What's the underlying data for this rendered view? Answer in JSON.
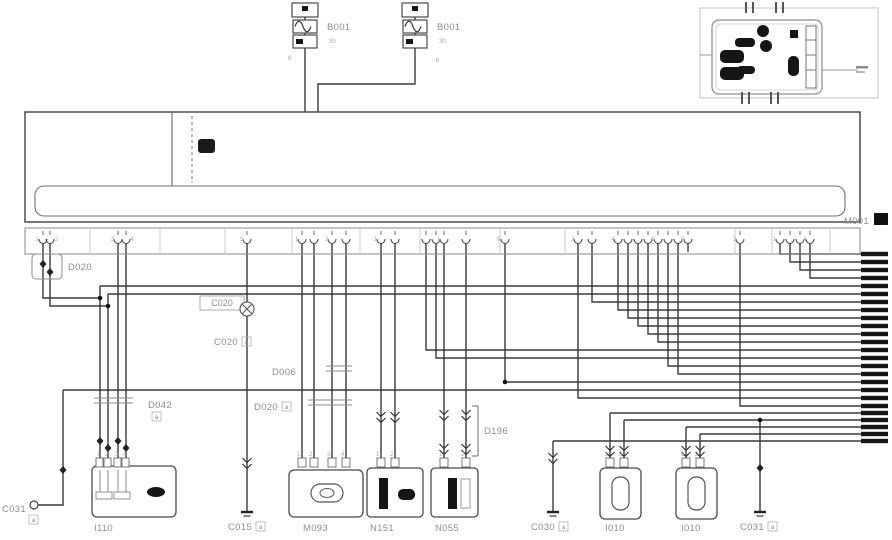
{
  "labels": {
    "fuse_a": "B001",
    "fuse_b": "B001",
    "main_unit": "M001",
    "d020": "D020",
    "c020_box": "C020",
    "c020a": {
      "text": "C020",
      "suffix": "a"
    },
    "d006": "D006",
    "d042": {
      "text": "D042",
      "suffix": "a"
    },
    "d020a": {
      "text": "D020",
      "suffix": "a"
    },
    "d196": "D196",
    "c031_left": {
      "text": "C031",
      "suffix": "a"
    },
    "c015": {
      "text": "C015",
      "suffix": "a"
    },
    "c030": {
      "text": "C030",
      "suffix": "a"
    },
    "c031_right": {
      "text": "C031",
      "suffix": "a"
    },
    "comp_left": "I110",
    "m093": "M093",
    "n151": "N151",
    "n055": "N055",
    "i010_a": "I010",
    "i010_b": "I010"
  },
  "colors": {
    "wire": "#3a3a3a",
    "tick": "#161616",
    "box": "#4a4a4a",
    "light_box": "#9a9a9a",
    "label": "#8f8f8f",
    "pin_number": "#a6a6a6",
    "fill_dark": "#151515"
  },
  "pin_labels": [
    {
      "x": 36,
      "y": 241,
      "t": "1"
    },
    {
      "x": 55,
      "y": 241,
      "t": "2"
    },
    {
      "x": 111,
      "y": 241,
      "t": "3"
    },
    {
      "x": 130,
      "y": 241,
      "t": "4"
    },
    {
      "x": 240,
      "y": 241,
      "t": "5"
    },
    {
      "x": 295,
      "y": 241,
      "t": "1"
    },
    {
      "x": 325,
      "y": 241,
      "t": "3"
    },
    {
      "x": 374,
      "y": 241,
      "t": "1"
    },
    {
      "x": 437,
      "y": 241,
      "t": "1"
    },
    {
      "x": 497,
      "y": 241,
      "t": "6"
    },
    {
      "x": 571,
      "y": 241,
      "t": "2"
    },
    {
      "x": 611,
      "y": 241,
      "t": "4"
    },
    {
      "x": 651,
      "y": 241,
      "t": "6"
    },
    {
      "x": 681,
      "y": 241,
      "t": "8"
    },
    {
      "x": 733,
      "y": 241,
      "t": "3"
    },
    {
      "x": 773,
      "y": 241,
      "t": "1"
    },
    {
      "x": 803,
      "y": 241,
      "t": "4"
    },
    {
      "x": 97,
      "y": 456,
      "t": "1"
    },
    {
      "x": 105,
      "y": 456,
      "t": "2"
    },
    {
      "x": 115,
      "y": 456,
      "t": "3"
    },
    {
      "x": 123,
      "y": 456,
      "t": "4"
    },
    {
      "x": 297,
      "y": 456,
      "t": "1"
    },
    {
      "x": 309,
      "y": 456,
      "t": "2"
    },
    {
      "x": 327,
      "y": 456,
      "t": "3"
    },
    {
      "x": 341,
      "y": 456,
      "t": "4"
    },
    {
      "x": 376,
      "y": 456,
      "t": "1"
    },
    {
      "x": 390,
      "y": 456,
      "t": "2"
    },
    {
      "x": 439,
      "y": 456,
      "t": "1"
    },
    {
      "x": 461,
      "y": 456,
      "t": "2"
    },
    {
      "x": 605,
      "y": 456,
      "t": "1"
    },
    {
      "x": 619,
      "y": 456,
      "t": "2"
    },
    {
      "x": 681,
      "y": 456,
      "t": "1"
    },
    {
      "x": 695,
      "y": 456,
      "t": "2"
    },
    {
      "x": 288,
      "y": 60,
      "t": "6"
    },
    {
      "x": 436,
      "y": 62,
      "t": "6"
    },
    {
      "x": 329,
      "y": 43,
      "t": "30"
    },
    {
      "x": 439,
      "y": 43,
      "t": "30"
    }
  ]
}
